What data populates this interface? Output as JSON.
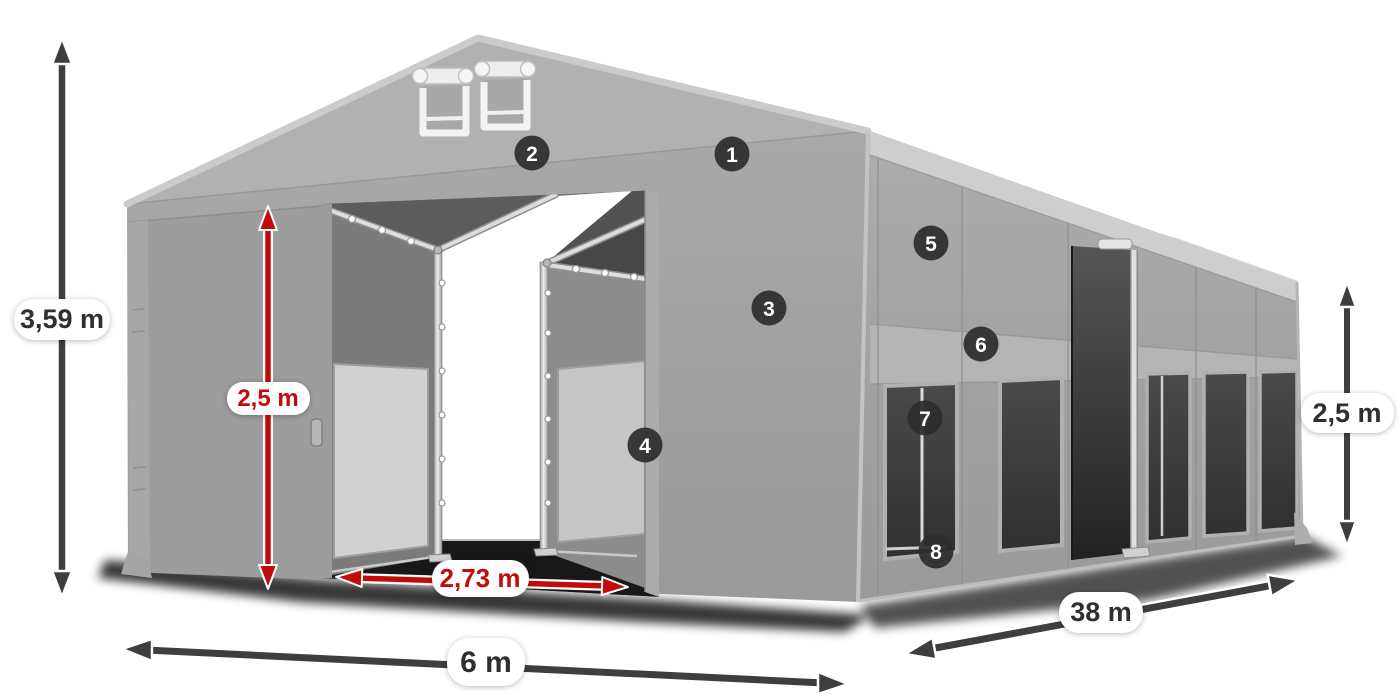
{
  "diagram": {
    "kind": "tent-dimension-diagram",
    "background": "#ffffff"
  },
  "colors": {
    "accent_red": "#c40b0b",
    "arrow_dark": "#3e3e3e",
    "arrow_casing": "#ffffff",
    "badge_bg": "#2d2d2d",
    "badge_text": "#ffffff",
    "label_bg": "#ffffff",
    "label_text": "#2f2f2f",
    "tent_wall": "#a2a2a2",
    "tent_roof": "#c6c6c6",
    "window_dark": "#3f3f3f"
  },
  "dimensions": {
    "total_height": "3,59 m",
    "entrance_height": "2,5 m",
    "entrance_width": "2,73 m",
    "tent_width": "6 m",
    "tent_length": "38 m",
    "side_height": "2,5 m"
  },
  "callouts": [
    {
      "number": "1"
    },
    {
      "number": "2"
    },
    {
      "number": "3"
    },
    {
      "number": "4"
    },
    {
      "number": "5"
    },
    {
      "number": "6"
    },
    {
      "number": "7"
    },
    {
      "number": "8"
    }
  ]
}
